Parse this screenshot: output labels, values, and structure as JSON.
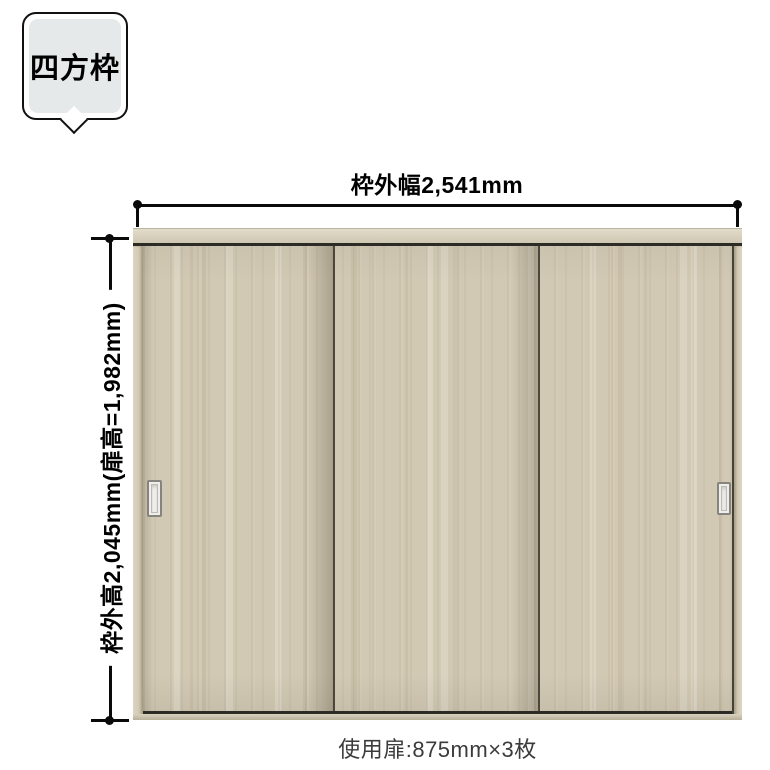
{
  "bubble": {
    "label": "四方枠"
  },
  "dimensions": {
    "width": {
      "label": "枠外幅2,541mm"
    },
    "height": {
      "label": "枠外高2,045mm(扉高=1,982mm)"
    }
  },
  "door": {
    "panel_count": 3
  },
  "footer": {
    "caption": "使用扉:875mm×3枚"
  },
  "colors": {
    "wood-base": "#d2c9b4",
    "frame-light": "#ddd6c4",
    "frame-dark": "#c9c0a8",
    "track-line": "#2c2b25",
    "panel-edge-line": "#4c463c",
    "dimension-line": "#0a0a0a",
    "bubble-fill": "#e6e9ea",
    "bubble-border": "#111111",
    "caption-text": "#3b3b3b"
  }
}
